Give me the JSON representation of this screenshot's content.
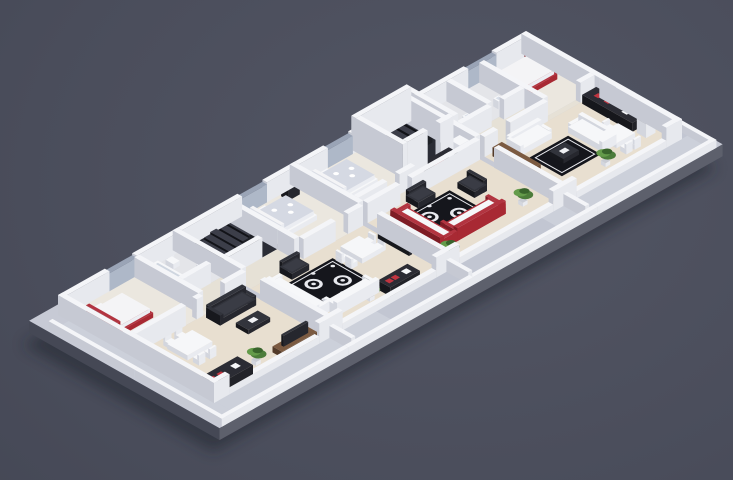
{
  "meta": {
    "scene": "isometric-apartment-floorplan-render",
    "apartment_count": 4,
    "view": "3d-isometric",
    "rooms": [
      "bedroom",
      "bathroom",
      "hallway",
      "living-room",
      "kitchen",
      "dining-area",
      "stair-core",
      "terrace"
    ]
  },
  "palette": {
    "bg": "#4a4d5b",
    "shadow": "#1f212a",
    "plinthTop": "#c7cad5",
    "plinthL": "#454855",
    "plinthR": "#5d606c",
    "terrace": "#ccd0da",
    "terraceAlt": "#c2c6d2",
    "floorWood": "#e8dfd0",
    "floorBed": "#ebe7df",
    "floorBath": "#e4e5e9",
    "floorHall": "#e6e1d6",
    "floorDark": "#2a2c35",
    "wallTop": "#f4f5f8",
    "wallL": "#c6c9d3",
    "wallR": "#e7e9ee",
    "glassTop": "#9aa4b6",
    "glassL": "#8690a4",
    "glassR": "#aeb8c8",
    "redTop": "#b23440",
    "redL": "#7e1c25",
    "redR": "#a82933",
    "wTop": "#f6f7f9",
    "wL": "#d3d6de",
    "wR": "#e9ebf0",
    "dkTop": "#32343c",
    "dkL": "#17181d",
    "dkR": "#26272e",
    "counterTop": "#2b2c34",
    "counterL": "#16171c",
    "counterR": "#222329",
    "woodTop": "#7b5a41",
    "woodL": "#523a29",
    "woodR": "#6b4e38",
    "rug": "#15161c",
    "rugLine": "#e8e9ee",
    "patTop": "#d5d9e3",
    "mTop": "#f4f4f6",
    "mL": "#dadde5",
    "mR": "#ebedf2",
    "green1": "#4c7c3a",
    "green2": "#649b4a",
    "green3": "#39642c",
    "hob": "#c03540",
    "potGray": "#c9ccd4",
    "stepTop": "#3c3e49",
    "stepL": "#121318",
    "stepR": "#1e2026",
    "tubIn": "#cfd6e0",
    "sinkIn": "#d7dde8",
    "tableDeco": "#f0f1f4"
  },
  "iso": {
    "ox": 58,
    "oy": 315,
    "ax": 0.78,
    "ay": 0.44
  },
  "elements": [
    {
      "t": "shadow",
      "x": -25,
      "y": -12,
      "w": 645,
      "d": 244
    },
    {
      "t": "plinth",
      "x": -25,
      "y": -12,
      "w": 645,
      "d": 244,
      "h": 12
    },
    {
      "t": "floor",
      "x": -18,
      "y": 14,
      "w": 20,
      "d": 214,
      "c": "terrace"
    },
    {
      "t": "floor",
      "x": 2,
      "y": 200,
      "w": 206,
      "d": 28,
      "c": "terrace"
    },
    {
      "t": "floor",
      "x": 208,
      "y": 200,
      "w": 212,
      "d": 28,
      "c": "terraceAlt"
    },
    {
      "t": "floor",
      "x": 420,
      "y": 200,
      "w": 188,
      "d": 28,
      "c": "terrace"
    },
    {
      "t": "floor",
      "x": 600,
      "y": -6,
      "w": 10,
      "d": 234,
      "c": "terraceAlt"
    },
    {
      "t": "floor",
      "x": 6,
      "y": 6,
      "w": 92,
      "d": 88,
      "c": "floorBed"
    },
    {
      "t": "floor",
      "x": 98,
      "y": 6,
      "w": 49,
      "d": 56,
      "c": "floorBath"
    },
    {
      "t": "floor",
      "x": 98,
      "y": 62,
      "w": 49,
      "d": 32,
      "c": "floorHall"
    },
    {
      "t": "floor",
      "x": 6,
      "y": 94,
      "w": 141,
      "d": 100,
      "c": "floorWood"
    },
    {
      "t": "floor",
      "x": 153,
      "y": 6,
      "w": 68,
      "d": 60,
      "c": "floorDark"
    },
    {
      "t": "floor",
      "x": 153,
      "y": 66,
      "w": 68,
      "d": 28,
      "c": "floorHall"
    },
    {
      "t": "floor",
      "x": 221,
      "y": 6,
      "w": 76,
      "d": 88,
      "c": "floorBed"
    },
    {
      "t": "floor",
      "x": 153,
      "y": 94,
      "w": 144,
      "d": 100,
      "c": "floorWood"
    },
    {
      "t": "floor",
      "x": 303,
      "y": 6,
      "w": 73,
      "d": 70,
      "c": "floorBed"
    },
    {
      "t": "floor",
      "x": 376,
      "y": 6,
      "w": 71,
      "d": 60,
      "c": "floorDark"
    },
    {
      "t": "floor",
      "x": 303,
      "y": 76,
      "w": 73,
      "d": 18,
      "c": "floorHall"
    },
    {
      "t": "floor",
      "x": 376,
      "y": 66,
      "w": 71,
      "d": 28,
      "c": "floorHall"
    },
    {
      "t": "floor",
      "x": 303,
      "y": 94,
      "w": 144,
      "d": 100,
      "c": "floorWood"
    },
    {
      "t": "floor",
      "x": 453,
      "y": 6,
      "w": 81,
      "d": 52,
      "c": "floorBath"
    },
    {
      "t": "floor",
      "x": 534,
      "y": 6,
      "w": 60,
      "d": 82,
      "c": "floorBed"
    },
    {
      "t": "floor",
      "x": 453,
      "y": 58,
      "w": 81,
      "d": 36,
      "c": "floorHall"
    },
    {
      "t": "floor",
      "x": 534,
      "y": 88,
      "w": 60,
      "d": 6,
      "c": "floorHall"
    },
    {
      "t": "floor",
      "x": 453,
      "y": 94,
      "w": 141,
      "d": 100,
      "c": "floorWood"
    },
    {
      "t": "rug",
      "x": 180,
      "y": 112,
      "w": 60,
      "d": 52,
      "s": "damask"
    },
    {
      "t": "rug",
      "x": 330,
      "y": 110,
      "w": 62,
      "d": 52,
      "s": "damask"
    },
    {
      "t": "rug",
      "x": 480,
      "y": 124,
      "w": 50,
      "d": 42,
      "s": "dark"
    },
    {
      "t": "wall",
      "x": 0,
      "y": 0,
      "w": 60,
      "d": 6
    },
    {
      "t": "glass",
      "x": 60,
      "y": 0,
      "w": 35,
      "d": 6
    },
    {
      "t": "wall",
      "x": 95,
      "y": 0,
      "w": 58,
      "d": 6
    },
    {
      "t": "wall",
      "x": 153,
      "y": 0,
      "w": 77,
      "d": 6
    },
    {
      "t": "glass",
      "x": 230,
      "y": 0,
      "w": 32,
      "d": 6
    },
    {
      "t": "wall",
      "x": 262,
      "y": 0,
      "w": 41,
      "d": 6
    },
    {
      "t": "wall",
      "x": 303,
      "y": 0,
      "w": 37,
      "d": 6
    },
    {
      "t": "glass",
      "x": 340,
      "y": 0,
      "w": 32,
      "d": 6
    },
    {
      "t": "wall",
      "x": 372,
      "y": 0,
      "w": 4,
      "d": 6
    },
    {
      "t": "wall",
      "x": 376,
      "y": 0,
      "w": 71,
      "d": 6,
      "h": 34
    },
    {
      "t": "wall",
      "x": 447,
      "y": 0,
      "w": 6,
      "d": 6
    },
    {
      "t": "wall",
      "x": 453,
      "y": 0,
      "w": 67,
      "d": 6
    },
    {
      "t": "glass",
      "x": 520,
      "y": 0,
      "w": 36,
      "d": 6
    },
    {
      "t": "wall",
      "x": 556,
      "y": 0,
      "w": 44,
      "d": 6
    },
    {
      "t": "wall",
      "x": 0,
      "y": 0,
      "w": 6,
      "d": 100
    },
    {
      "t": "wall",
      "x": 0,
      "y": 100,
      "w": 6,
      "d": 100
    },
    {
      "t": "wall",
      "x": 594,
      "y": 0,
      "w": 6,
      "d": 100
    },
    {
      "t": "wall",
      "x": 594,
      "y": 100,
      "w": 6,
      "d": 100
    },
    {
      "t": "wall",
      "x": 0,
      "y": 194,
      "w": 20,
      "d": 6
    },
    {
      "t": "lowwall",
      "x": 20,
      "y": 194,
      "w": 115,
      "d": 6,
      "h": 7
    },
    {
      "t": "wall",
      "x": 135,
      "y": 194,
      "w": 30,
      "d": 6
    },
    {
      "t": "lowwall",
      "x": 165,
      "y": 194,
      "w": 120,
      "d": 6,
      "h": 7
    },
    {
      "t": "wall",
      "x": 285,
      "y": 194,
      "w": 30,
      "d": 6
    },
    {
      "t": "lowwall",
      "x": 315,
      "y": 194,
      "w": 120,
      "d": 6,
      "h": 7
    },
    {
      "t": "wall",
      "x": 435,
      "y": 194,
      "w": 30,
      "d": 6
    },
    {
      "t": "lowwall",
      "x": 465,
      "y": 194,
      "w": 115,
      "d": 6,
      "h": 7
    },
    {
      "t": "wall",
      "x": 580,
      "y": 194,
      "w": 20,
      "d": 6
    },
    {
      "t": "wall",
      "x": 147,
      "y": 0,
      "w": 6,
      "d": 88
    },
    {
      "t": "wall",
      "x": 147,
      "y": 112,
      "w": 6,
      "d": 82
    },
    {
      "t": "wall",
      "x": 297,
      "y": 0,
      "w": 6,
      "d": 88
    },
    {
      "t": "wall",
      "x": 297,
      "y": 112,
      "w": 6,
      "d": 82
    },
    {
      "t": "wall",
      "x": 447,
      "y": 0,
      "w": 6,
      "d": 88
    },
    {
      "t": "wall",
      "x": 447,
      "y": 112,
      "w": 6,
      "d": 82
    },
    {
      "t": "wall",
      "x": 92,
      "y": 6,
      "w": 6,
      "d": 82
    },
    {
      "t": "wall",
      "x": 6,
      "y": 88,
      "w": 64,
      "d": 6
    },
    {
      "t": "wall",
      "x": 84,
      "y": 88,
      "w": 8,
      "d": 6
    },
    {
      "t": "wall",
      "x": 120,
      "y": 88,
      "w": 27,
      "d": 6
    },
    {
      "t": "wall",
      "x": 98,
      "y": 56,
      "w": 36,
      "d": 6
    },
    {
      "t": "wall",
      "x": 215,
      "y": 6,
      "w": 6,
      "d": 60
    },
    {
      "t": "wall",
      "x": 153,
      "y": 60,
      "w": 43,
      "d": 6
    },
    {
      "t": "wall",
      "x": 215,
      "y": 66,
      "w": 6,
      "d": 22
    },
    {
      "t": "wall",
      "x": 221,
      "y": 88,
      "w": 41,
      "d": 6
    },
    {
      "t": "wall",
      "x": 278,
      "y": 88,
      "w": 19,
      "d": 6
    },
    {
      "t": "wall",
      "x": 303,
      "y": 76,
      "w": 37,
      "d": 6
    },
    {
      "t": "wall",
      "x": 356,
      "y": 76,
      "w": 20,
      "d": 6
    },
    {
      "t": "wall",
      "x": 376,
      "y": 6,
      "w": 6,
      "d": 60,
      "h": 34
    },
    {
      "t": "wall",
      "x": 441,
      "y": 6,
      "w": 6,
      "d": 60,
      "h": 34
    },
    {
      "t": "wall",
      "x": 382,
      "y": 60,
      "w": 26,
      "d": 6,
      "h": 34
    },
    {
      "t": "wall",
      "x": 424,
      "y": 60,
      "w": 17,
      "d": 6,
      "h": 34
    },
    {
      "t": "wall",
      "x": 303,
      "y": 88,
      "w": 42,
      "d": 6
    },
    {
      "t": "wall",
      "x": 360,
      "y": 88,
      "w": 87,
      "d": 6
    },
    {
      "t": "wall",
      "x": 453,
      "y": 58,
      "w": 39,
      "d": 6
    },
    {
      "t": "wall",
      "x": 508,
      "y": 58,
      "w": 26,
      "d": 6
    },
    {
      "t": "wall",
      "x": 492,
      "y": 6,
      "w": 6,
      "d": 52
    },
    {
      "t": "wall",
      "x": 534,
      "y": 6,
      "w": 6,
      "d": 82
    },
    {
      "t": "wall",
      "x": 453,
      "y": 88,
      "w": 17,
      "d": 6
    },
    {
      "t": "wall",
      "x": 486,
      "y": 88,
      "w": 48,
      "d": 6
    },
    {
      "t": "wall",
      "x": 576,
      "y": 88,
      "w": 18,
      "d": 6
    },
    {
      "t": "lowwall",
      "x": 148,
      "y": 200,
      "w": 5,
      "d": 28,
      "h": 12
    },
    {
      "t": "lowwall",
      "x": 298,
      "y": 200,
      "w": 5,
      "d": 28,
      "h": 12
    },
    {
      "t": "lowwall",
      "x": 448,
      "y": 200,
      "w": 5,
      "d": 28,
      "h": 12
    },
    {
      "t": "lowwall",
      "x": -22,
      "y": 10,
      "w": 5,
      "d": 110,
      "h": 8
    },
    {
      "t": "lowwall",
      "x": -22,
      "y": 120,
      "w": 5,
      "d": 112,
      "h": 8
    },
    {
      "t": "lowwall",
      "x": -22,
      "y": 227,
      "w": 162,
      "d": 5,
      "h": 8
    },
    {
      "t": "lowwall",
      "x": 140,
      "y": 227,
      "w": 160,
      "d": 5,
      "h": 8
    },
    {
      "t": "lowwall",
      "x": 300,
      "y": 227,
      "w": 160,
      "d": 5,
      "h": 8
    },
    {
      "t": "lowwall",
      "x": 460,
      "y": 227,
      "w": 152,
      "d": 5,
      "h": 8
    },
    {
      "t": "lowwall",
      "x": 607,
      "y": -10,
      "w": 5,
      "d": 120,
      "h": 8
    },
    {
      "t": "lowwall",
      "x": 607,
      "y": 108,
      "w": 5,
      "d": 124,
      "h": 8
    },
    {
      "t": "bed",
      "x": 12,
      "y": 24,
      "w": 46,
      "d": 40,
      "s": "red",
      "head": "W"
    },
    {
      "t": "box",
      "x": 12,
      "y": 12,
      "w": 9,
      "d": 9,
      "h": 6,
      "c": "white"
    },
    {
      "t": "box",
      "x": 12,
      "y": 67,
      "w": 9,
      "d": 9,
      "h": 6,
      "c": "white"
    },
    {
      "t": "tub",
      "x": 100,
      "y": 10,
      "w": 18,
      "d": 42
    },
    {
      "t": "toilet",
      "x": 126,
      "y": 12
    },
    {
      "t": "sink",
      "x": 137,
      "y": 40
    },
    {
      "t": "kitchen",
      "x": 8,
      "y": 172,
      "w": 50,
      "d": 20
    },
    {
      "t": "dining",
      "x": 28,
      "y": 112,
      "w": 32,
      "d": 26
    },
    {
      "t": "sofa",
      "x": 92,
      "y": 98,
      "w": 46,
      "d": 18,
      "face": "S",
      "c": "dark"
    },
    {
      "t": "ctable",
      "x": 100,
      "y": 128,
      "w": 28,
      "d": 16
    },
    {
      "t": "tvunit",
      "x": 95,
      "y": 180,
      "w": 45,
      "d": 12
    },
    {
      "t": "plant",
      "x": 72,
      "y": 182
    },
    {
      "t": "stairs",
      "x": 158,
      "y": 14,
      "w": 54,
      "d": 34,
      "steps": 7,
      "h": 16
    },
    {
      "t": "bed",
      "x": 228,
      "y": 18,
      "w": 46,
      "d": 40,
      "s": "pat",
      "head": "W"
    },
    {
      "t": "box",
      "x": 278,
      "y": 8,
      "w": 14,
      "d": 10,
      "h": 16,
      "c": "dark"
    },
    {
      "t": "sofa",
      "x": 160,
      "y": 106,
      "w": 18,
      "d": 64,
      "face": "E",
      "c": "white"
    },
    {
      "t": "sofa",
      "x": 178,
      "y": 162,
      "w": 54,
      "d": 18,
      "face": "N",
      "c": "white"
    },
    {
      "t": "armchair",
      "x": 190,
      "y": 94,
      "w": 22,
      "d": 16,
      "face": "S",
      "c": "dark"
    },
    {
      "t": "tv",
      "x": 292,
      "y": 118,
      "w": 4,
      "d": 40
    },
    {
      "t": "dining",
      "x": 250,
      "y": 112,
      "w": 24,
      "d": 28
    },
    {
      "t": "kitchen",
      "x": 234,
      "y": 176,
      "w": 38,
      "d": 16
    },
    {
      "t": "plant",
      "x": 218,
      "y": 182
    },
    {
      "t": "bed",
      "x": 310,
      "y": 16,
      "w": 44,
      "d": 40,
      "s": "pat",
      "head": "W"
    },
    {
      "t": "stairs",
      "x": 388,
      "y": 12,
      "w": 48,
      "d": 32,
      "steps": 7,
      "h": 18
    },
    {
      "t": "kitchen",
      "x": 398,
      "y": 70,
      "w": 33,
      "d": 18
    },
    {
      "t": "box",
      "x": 433,
      "y": 70,
      "w": 12,
      "d": 12,
      "h": 15,
      "c": "white"
    },
    {
      "t": "sofa",
      "x": 318,
      "y": 108,
      "w": 22,
      "d": 64,
      "face": "E",
      "c": "red"
    },
    {
      "t": "sofa",
      "x": 340,
      "y": 150,
      "w": 62,
      "d": 22,
      "face": "N",
      "c": "red"
    },
    {
      "t": "armchair",
      "x": 352,
      "y": 94,
      "w": 22,
      "d": 16,
      "face": "S",
      "c": "dark"
    },
    {
      "t": "armchair",
      "x": 400,
      "y": 112,
      "w": 16,
      "d": 22,
      "face": "W",
      "c": "dark"
    },
    {
      "t": "tv",
      "x": 307,
      "y": 118,
      "w": 4,
      "d": 40
    },
    {
      "t": "plant",
      "x": 424,
      "y": 172
    },
    {
      "t": "plant",
      "x": 318,
      "y": 184
    },
    {
      "t": "box",
      "x": 459,
      "y": 98,
      "w": 12,
      "d": 50,
      "h": 9,
      "c": "wood"
    },
    {
      "t": "sofa",
      "x": 477,
      "y": 98,
      "w": 40,
      "d": 18,
      "face": "S",
      "c": "white"
    },
    {
      "t": "sofa",
      "x": 534,
      "y": 120,
      "w": 18,
      "d": 44,
      "face": "W",
      "c": "white"
    },
    {
      "t": "ctable",
      "x": 496,
      "y": 134,
      "w": 20,
      "d": 18
    },
    {
      "t": "dining",
      "x": 544,
      "y": 150,
      "w": 24,
      "d": 22
    },
    {
      "t": "kitchen",
      "x": 576,
      "y": 96,
      "w": 18,
      "d": 64
    },
    {
      "t": "box",
      "x": 578,
      "y": 164,
      "w": 12,
      "d": 12,
      "h": 14,
      "c": "white"
    },
    {
      "t": "bed",
      "x": 544,
      "y": 14,
      "w": 44,
      "d": 38,
      "s": "red",
      "head": "E"
    },
    {
      "t": "toilet",
      "x": 458,
      "y": 12
    },
    {
      "t": "sink",
      "x": 476,
      "y": 42
    },
    {
      "t": "toilet",
      "x": 502,
      "y": 12
    },
    {
      "t": "sink",
      "x": 516,
      "y": 42
    },
    {
      "t": "plant",
      "x": 522,
      "y": 180
    }
  ]
}
